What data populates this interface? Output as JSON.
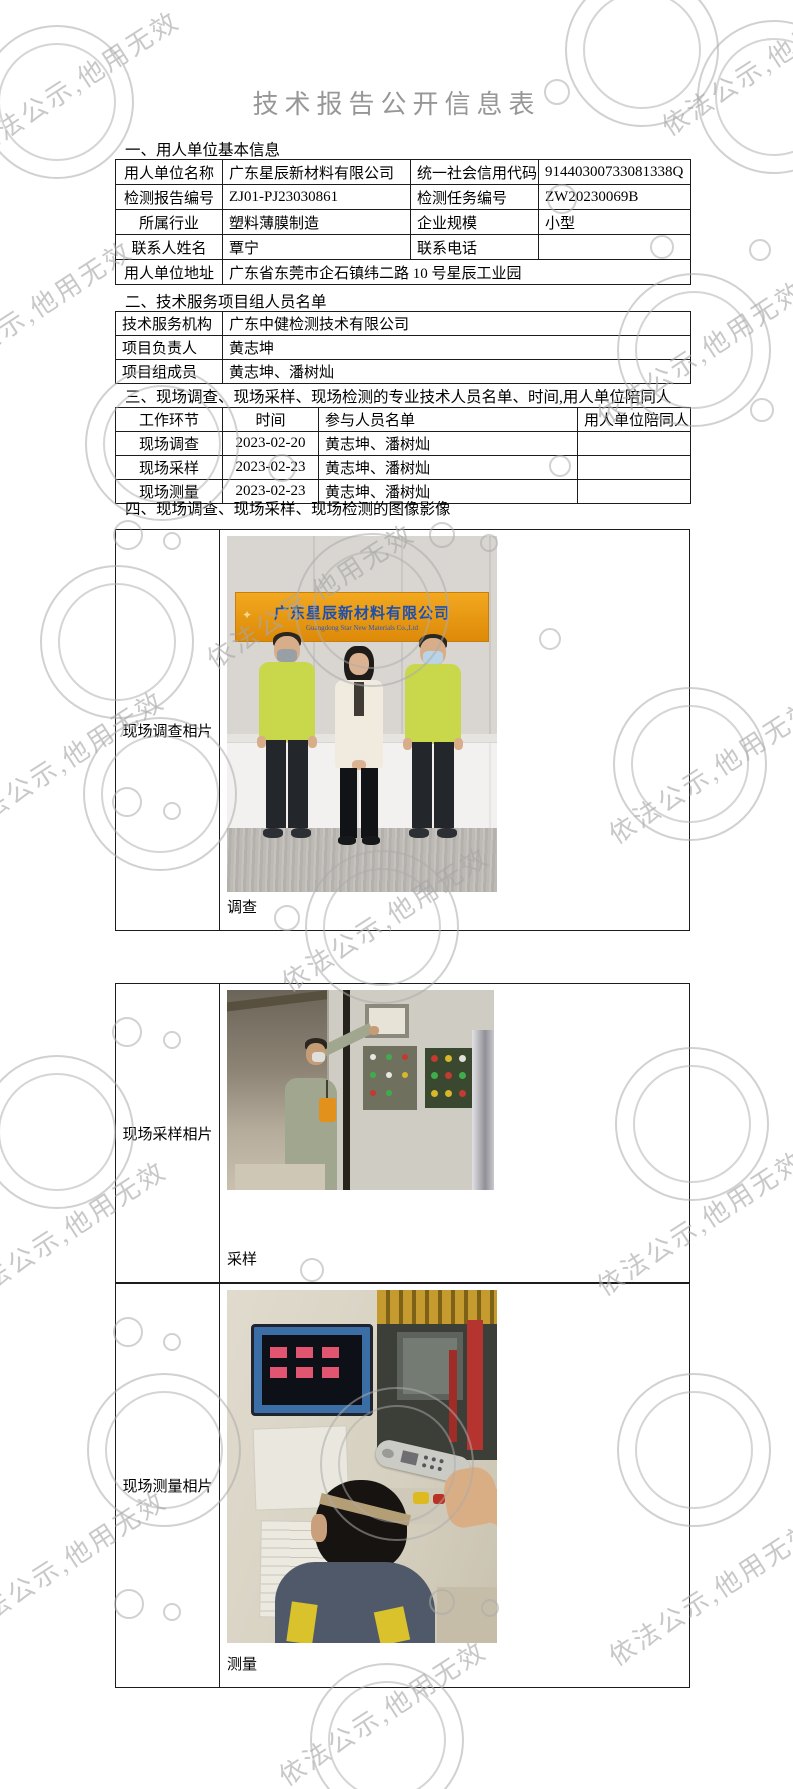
{
  "title": "技术报告公开信息表",
  "watermark": {
    "text": "依法公示,他用无效"
  },
  "sections": {
    "s1": {
      "heading": "一、用人单位基本信息",
      "rows": [
        [
          "用人单位名称",
          "广东星辰新材料有限公司",
          "统一社会信用代码",
          "91440300733081338Q"
        ],
        [
          "检测报告编号",
          "ZJ01-PJ23030861",
          "检测任务编号",
          "ZW20230069B"
        ],
        [
          "所属行业",
          "塑料薄膜制造",
          "企业规模",
          "小型"
        ],
        [
          "联系人姓名",
          "覃宁",
          "联系电话",
          ""
        ],
        [
          "用人单位地址",
          "广东省东莞市企石镇纬二路 10 号星辰工业园"
        ]
      ]
    },
    "s2": {
      "heading": "二、技术服务项目组人员名单",
      "rows": [
        [
          "技术服务机构",
          "广东中健检测技术有限公司"
        ],
        [
          "项目负责人",
          "黄志坤"
        ],
        [
          "项目组成员",
          "黄志坤、潘树灿"
        ]
      ]
    },
    "s3": {
      "heading": "三、现场调查、现场采样、现场检测的专业技术人员名单、时间,用人单位陪同人",
      "headers": [
        "工作环节",
        "时间",
        "参与人员名单",
        "用人单位陪同人"
      ],
      "rows": [
        [
          "现场调查",
          "2023-02-20",
          "黄志坤、潘树灿",
          ""
        ],
        [
          "现场采样",
          "2023-02-23",
          "黄志坤、潘树灿",
          ""
        ],
        [
          "现场测量",
          "2023-02-23",
          "黄志坤、潘树灿",
          ""
        ]
      ]
    },
    "s4": {
      "heading": "四、现场调查、现场采样、现场检测的图像影像",
      "photos": [
        {
          "label": "现场调查相片",
          "caption": "调查"
        },
        {
          "label": "现场采样相片",
          "caption": "采样"
        },
        {
          "label": "现场测量相片",
          "caption": "测量"
        }
      ]
    }
  },
  "photo1": {
    "banner_cn": "广东星辰新材料有限公司",
    "banner_en": "Guangdong Star New Materials Co.,Ltd"
  },
  "colors": {
    "banner_orange": "#e8930c",
    "banner_text_blue": "#1d4fb0",
    "polo_green": "#c9d84a",
    "watermark_gray": "#acacac"
  }
}
